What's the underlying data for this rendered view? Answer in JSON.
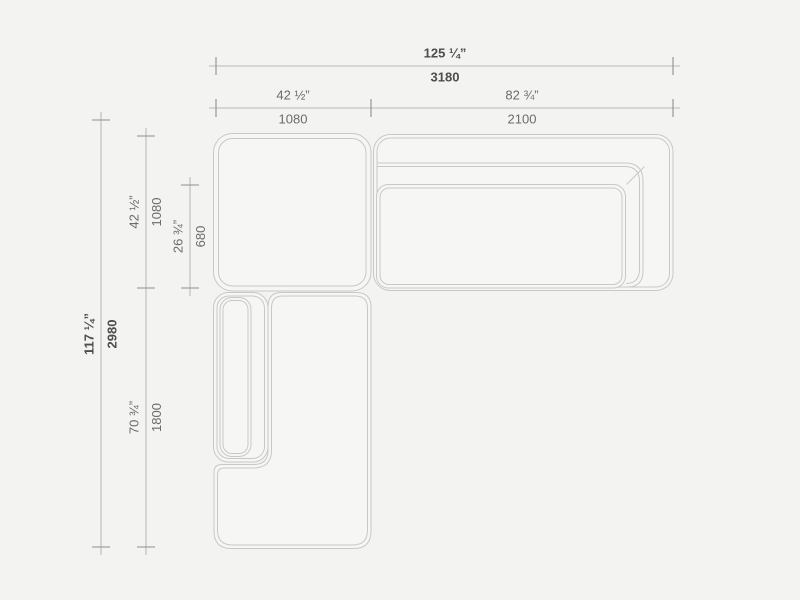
{
  "dims": {
    "overall_width": {
      "in": "125 ¼”",
      "mm": "3180"
    },
    "module_left_width": {
      "in": "42 ½”",
      "mm": "1080"
    },
    "module_right_width": {
      "in": "82 ¾”",
      "mm": "2100"
    },
    "overall_depth": {
      "in": "117 ¼”",
      "mm": "2980"
    },
    "corner_module_depth": {
      "in": "42 ½”",
      "mm": "1080"
    },
    "seat_depth": {
      "in": "26 ¾”",
      "mm": "680"
    },
    "chaise_length": {
      "in": "70 ¾”",
      "mm": "1800"
    }
  },
  "colors": {
    "background": "#f3f3f2",
    "module_outline": "#c8c8c7",
    "dimension_line": "#a6a6a6",
    "tick": "#8f8f8f",
    "label_text": "#6b6b6b",
    "label_text_bold": "#4d4d4d"
  }
}
